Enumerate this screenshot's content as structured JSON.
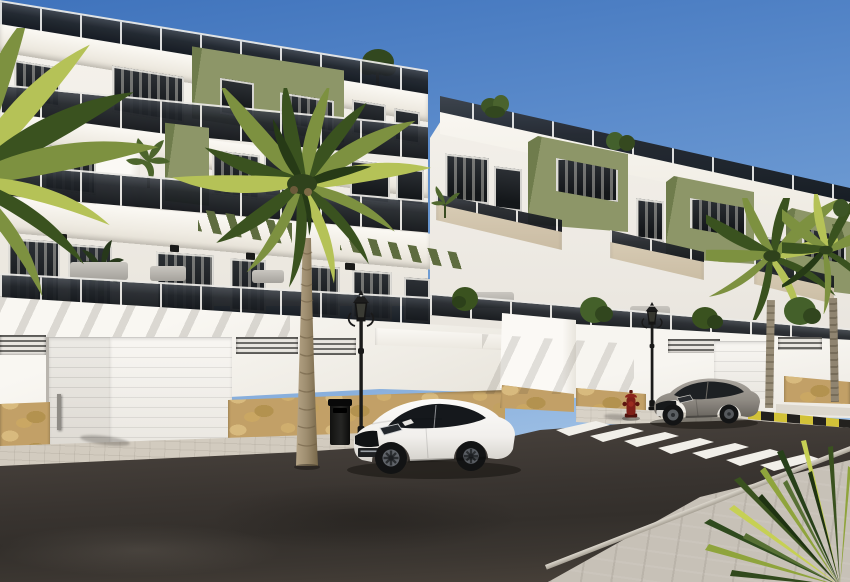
{
  "scene": {
    "title": "Street-level architectural rendering of a new residential development",
    "description": "Three-storey white and olive-green apartment block with glass balconies, street-level garages on a sunny street with palm trees, two parked coupes, ornate street lamps, a litter bin, a red fire hydrant and a zebra crosswalk under a clear blue sky",
    "weather": "clear sunny sky",
    "no_visible_text": true,
    "objects": {
      "buildings": [
        {
          "name": "left apartment block",
          "storeys": 3,
          "facade": "white with olive-green accent panels, tinted-glass balconies, green slatted pergolas"
        },
        {
          "name": "right apartment block",
          "storeys": 3,
          "facade": "white with olive-green cubic volumes, cream balcony bands, rooftop terraces with plants"
        }
      ],
      "vehicles": [
        {
          "name": "white coupe",
          "style": "Audi-TT-like coupe",
          "position": "parked at left kerb"
        },
        {
          "name": "grey coupe",
          "style": "Megane-like coupe",
          "position": "parked beyond crosswalk"
        }
      ],
      "street_furniture": [
        "ornate black street lamp (left)",
        "ornate black street lamp (right)",
        "black litter bin",
        "red fire hydrant"
      ],
      "vegetation": [
        "large palm tree at kerb",
        "palm fronds entering from left edge",
        "two slim palms on right sidewalk",
        "spiky palm fronds bottom-right foreground",
        "balcony and rooftop plants"
      ],
      "road_markings": [
        "white zebra crosswalk, 7 stripes",
        "yellow and black painted kerb on the right"
      ]
    },
    "counts": {
      "crosswalk_stripes": 7,
      "garage_doors_visible": 3,
      "street_lamps": 2,
      "parked_cars": 2,
      "litter_bins": 1,
      "fire_hydrants": 1
    }
  },
  "colors": {
    "sky_top": "#3f73bc",
    "sky_mid": "#6f9cd3",
    "sky_low": "#a6c6e8",
    "sky_horizon": "#c9ddf2",
    "white_lit": "#f7f5f0",
    "white_soft": "#efece6",
    "white_shade": "#dcd8d1",
    "cream": "#d9cdb6",
    "cream_shade": "#c8baa1",
    "green": "#8d9668",
    "green_dark": "#6f7c4c",
    "green_deep": "#5e6c3f",
    "glass_top": "#41464d",
    "glass_bot": "#101317",
    "stone": "#c2a067",
    "stone_dark": "#8a7144",
    "road_hi": "#4c4742",
    "road": "#3c3834",
    "road_low": "#2f2c29",
    "walk": "#d2cbbf",
    "walk_fore": "#c7c1b7",
    "curbface": "#b3ada2",
    "stripe": "#f1efe9",
    "kerb_yellow": "#d2c238",
    "kerb_black": "#23211e",
    "car_white": "#f3f2f0",
    "car_grey": "#8f8a83",
    "lamp_black": "#1b1b1a",
    "hydrant_red": "#7f2019",
    "palm_bright": "#b5c257",
    "palm_mid": "#7d9140",
    "palm_dark": "#3a521f",
    "palm_deep": "#263a16",
    "trunk": "#9d8c6e",
    "trunk_dark": "#7c6c50"
  }
}
